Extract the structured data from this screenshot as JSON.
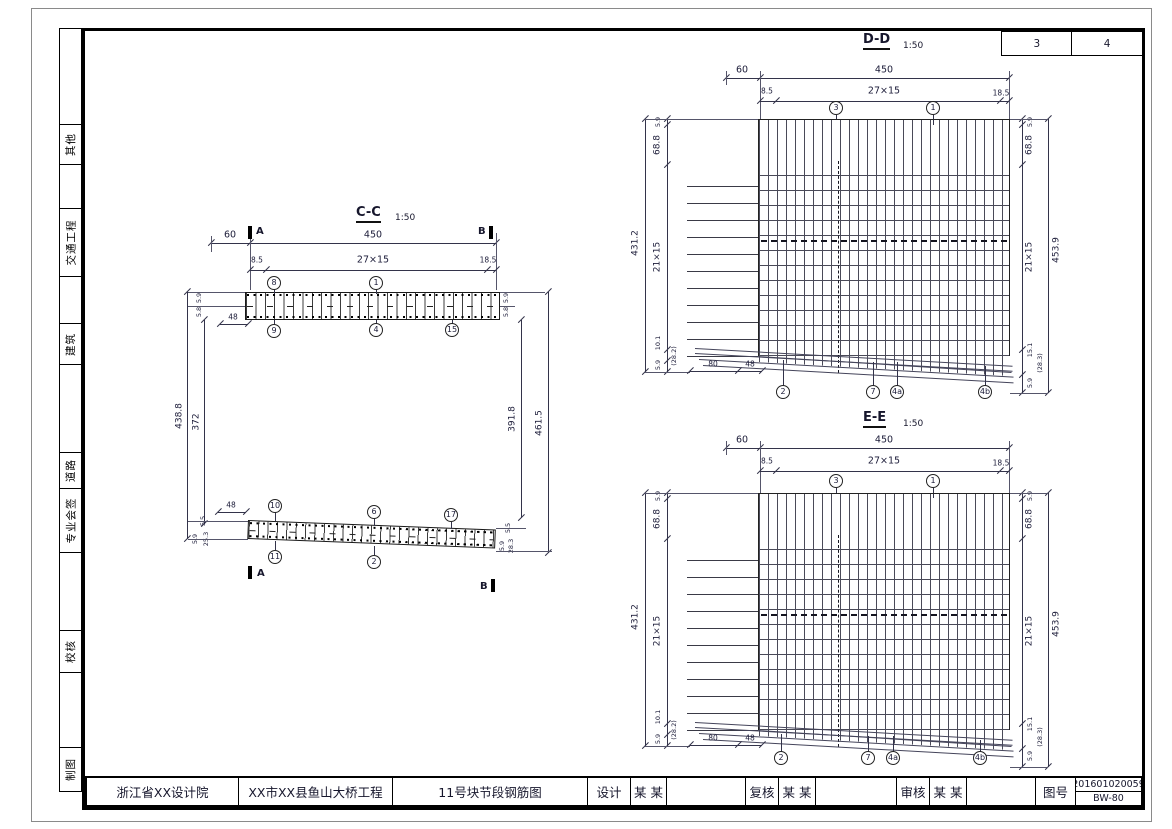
{
  "sheet": {
    "pages": [
      "3",
      "4"
    ]
  },
  "sidebar": {
    "items": [
      "其他",
      "交通工程",
      "建筑",
      "道路",
      "专业会签",
      "校核",
      "制图"
    ]
  },
  "title_block": {
    "org": "浙江省XX设计院",
    "project": "XX市XX县鱼山大桥工程",
    "drawing_title": "11号块节段钢筋图",
    "design_label": "设计",
    "design_name": "某 某",
    "recheck_label": "复核",
    "recheck_name": "某 某",
    "review_label": "审核",
    "review_name": "某 某",
    "figno_label": "图号",
    "figno_line1": "201601020059",
    "figno_line2": "BW-80"
  },
  "cc": {
    "title": "C-C",
    "scale": "1:50",
    "marker_a": "A",
    "marker_b": "B",
    "top": {
      "d60": "60",
      "d450": "450",
      "d85": "8.5",
      "d2715": "27×15",
      "d185": "18.5",
      "d48": "48",
      "left59": "5.9",
      "left58": "5.8",
      "right59": "5.9",
      "right58": "5.8",
      "bars_above": [
        "8",
        "1"
      ],
      "bars_below": [
        "9",
        "4",
        "15"
      ]
    },
    "mid": {
      "h1": "438.8",
      "h2": "372",
      "h3": "391.8",
      "h4": "461.5"
    },
    "bot": {
      "d48": "48",
      "left55": "5.5",
      "left59": "5.9",
      "left253": "25.3",
      "right55": "5.5",
      "right59": "5.9",
      "right283": "28.3",
      "bars_above": [
        "10",
        "6",
        "17"
      ],
      "bars_below": [
        "11",
        "2"
      ]
    }
  },
  "dd": {
    "title": "D-D",
    "scale": "1:50",
    "d60": "60",
    "d450": "450",
    "d85": "8.5",
    "d2715": "27×15",
    "d185": "18.5",
    "bars_top": [
      "3",
      "1"
    ],
    "bars_bottom": [
      "2",
      "7",
      "4a",
      "4b"
    ],
    "left": {
      "total": "431.2",
      "pitch": "21×15",
      "t59": "5.9",
      "t688": "68.8",
      "b101": "10.1",
      "b59": "5.9",
      "b282": "(28.2)"
    },
    "right": {
      "total": "453.9",
      "pitch": "21×15",
      "t59": "5.9",
      "t688": "68.8",
      "b151": "15.1",
      "b59": "5.9",
      "b283": "(28.3)"
    },
    "bottom": {
      "d80": "80",
      "d48": "48"
    }
  },
  "ee": {
    "title": "E-E",
    "scale": "1:50",
    "d60": "60",
    "d450": "450",
    "d85": "8.5",
    "d2715": "27×15",
    "d185": "18.5",
    "bars_top": [
      "3",
      "1"
    ],
    "bars_bottom": [
      "2",
      "7",
      "4a",
      "4b"
    ],
    "left": {
      "total": "431.2",
      "pitch": "21×15",
      "t59": "5.9",
      "t688": "68.8",
      "b101": "10.1",
      "b59": "5.9",
      "b282": "(28.2)"
    },
    "right": {
      "total": "453.9",
      "pitch": "21×15",
      "t59": "5.9",
      "t688": "68.8",
      "b151": "15.1",
      "b59": "5.9",
      "b283": "(28.3)"
    },
    "bottom": {
      "d80": "80",
      "d48": "48"
    }
  }
}
